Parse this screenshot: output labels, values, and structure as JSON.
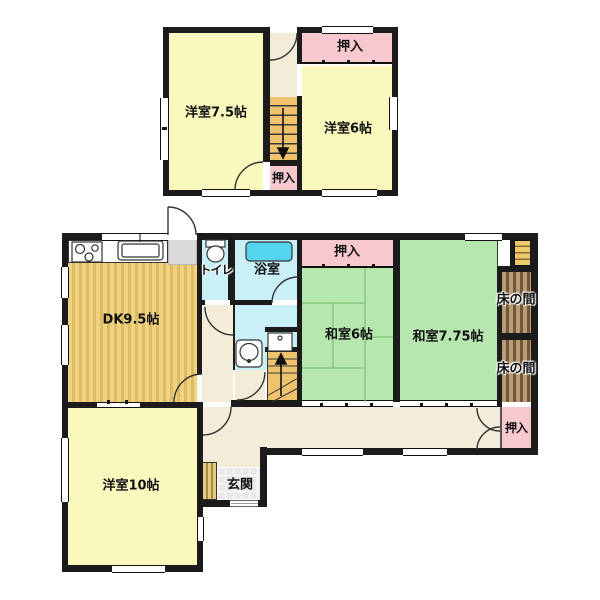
{
  "title": "Japanese house floor plan",
  "floor2": {
    "rooms": {
      "yoshitsu75": "洋室7.5帖",
      "yoshitsu6": "洋室6帖",
      "oshiire_top": "押入",
      "oshiire_stair": "押入"
    }
  },
  "floor1": {
    "rooms": {
      "dk": "DK9.5帖",
      "toilet": "トイレ",
      "bath": "浴室",
      "oshiire_north": "押入",
      "washitsu6": "和室6帖",
      "washitsu775": "和室7.75帖",
      "tokonoma_upper": "床の間",
      "tokonoma_lower": "床の間",
      "oshiire_se": "押入",
      "yoshitsu10": "洋室10帖",
      "genkan": "玄関"
    }
  },
  "icons": {
    "stairs_down_arrow": "↓",
    "stairs_up_arrow": "↑",
    "fixtures": [
      "stove",
      "kitchen-sink",
      "toilet",
      "bathtub",
      "washbasin",
      "washing-machine"
    ]
  },
  "colors": {
    "wall": "#1b1b1b",
    "western_room_yellow": "#F9F9BE",
    "closet_pink": "#F7C9CE",
    "tatami_green": "#B5E7AE",
    "wet_area_cyan": "#C9EFF7",
    "bathtub_cyan": "#55D6F0",
    "hall_beige": "#F3ECD9",
    "wood_floor_tan": "#E8C873",
    "stairs_tan": "#EFC36E",
    "tokonoma_brown": "#8A7050"
  }
}
